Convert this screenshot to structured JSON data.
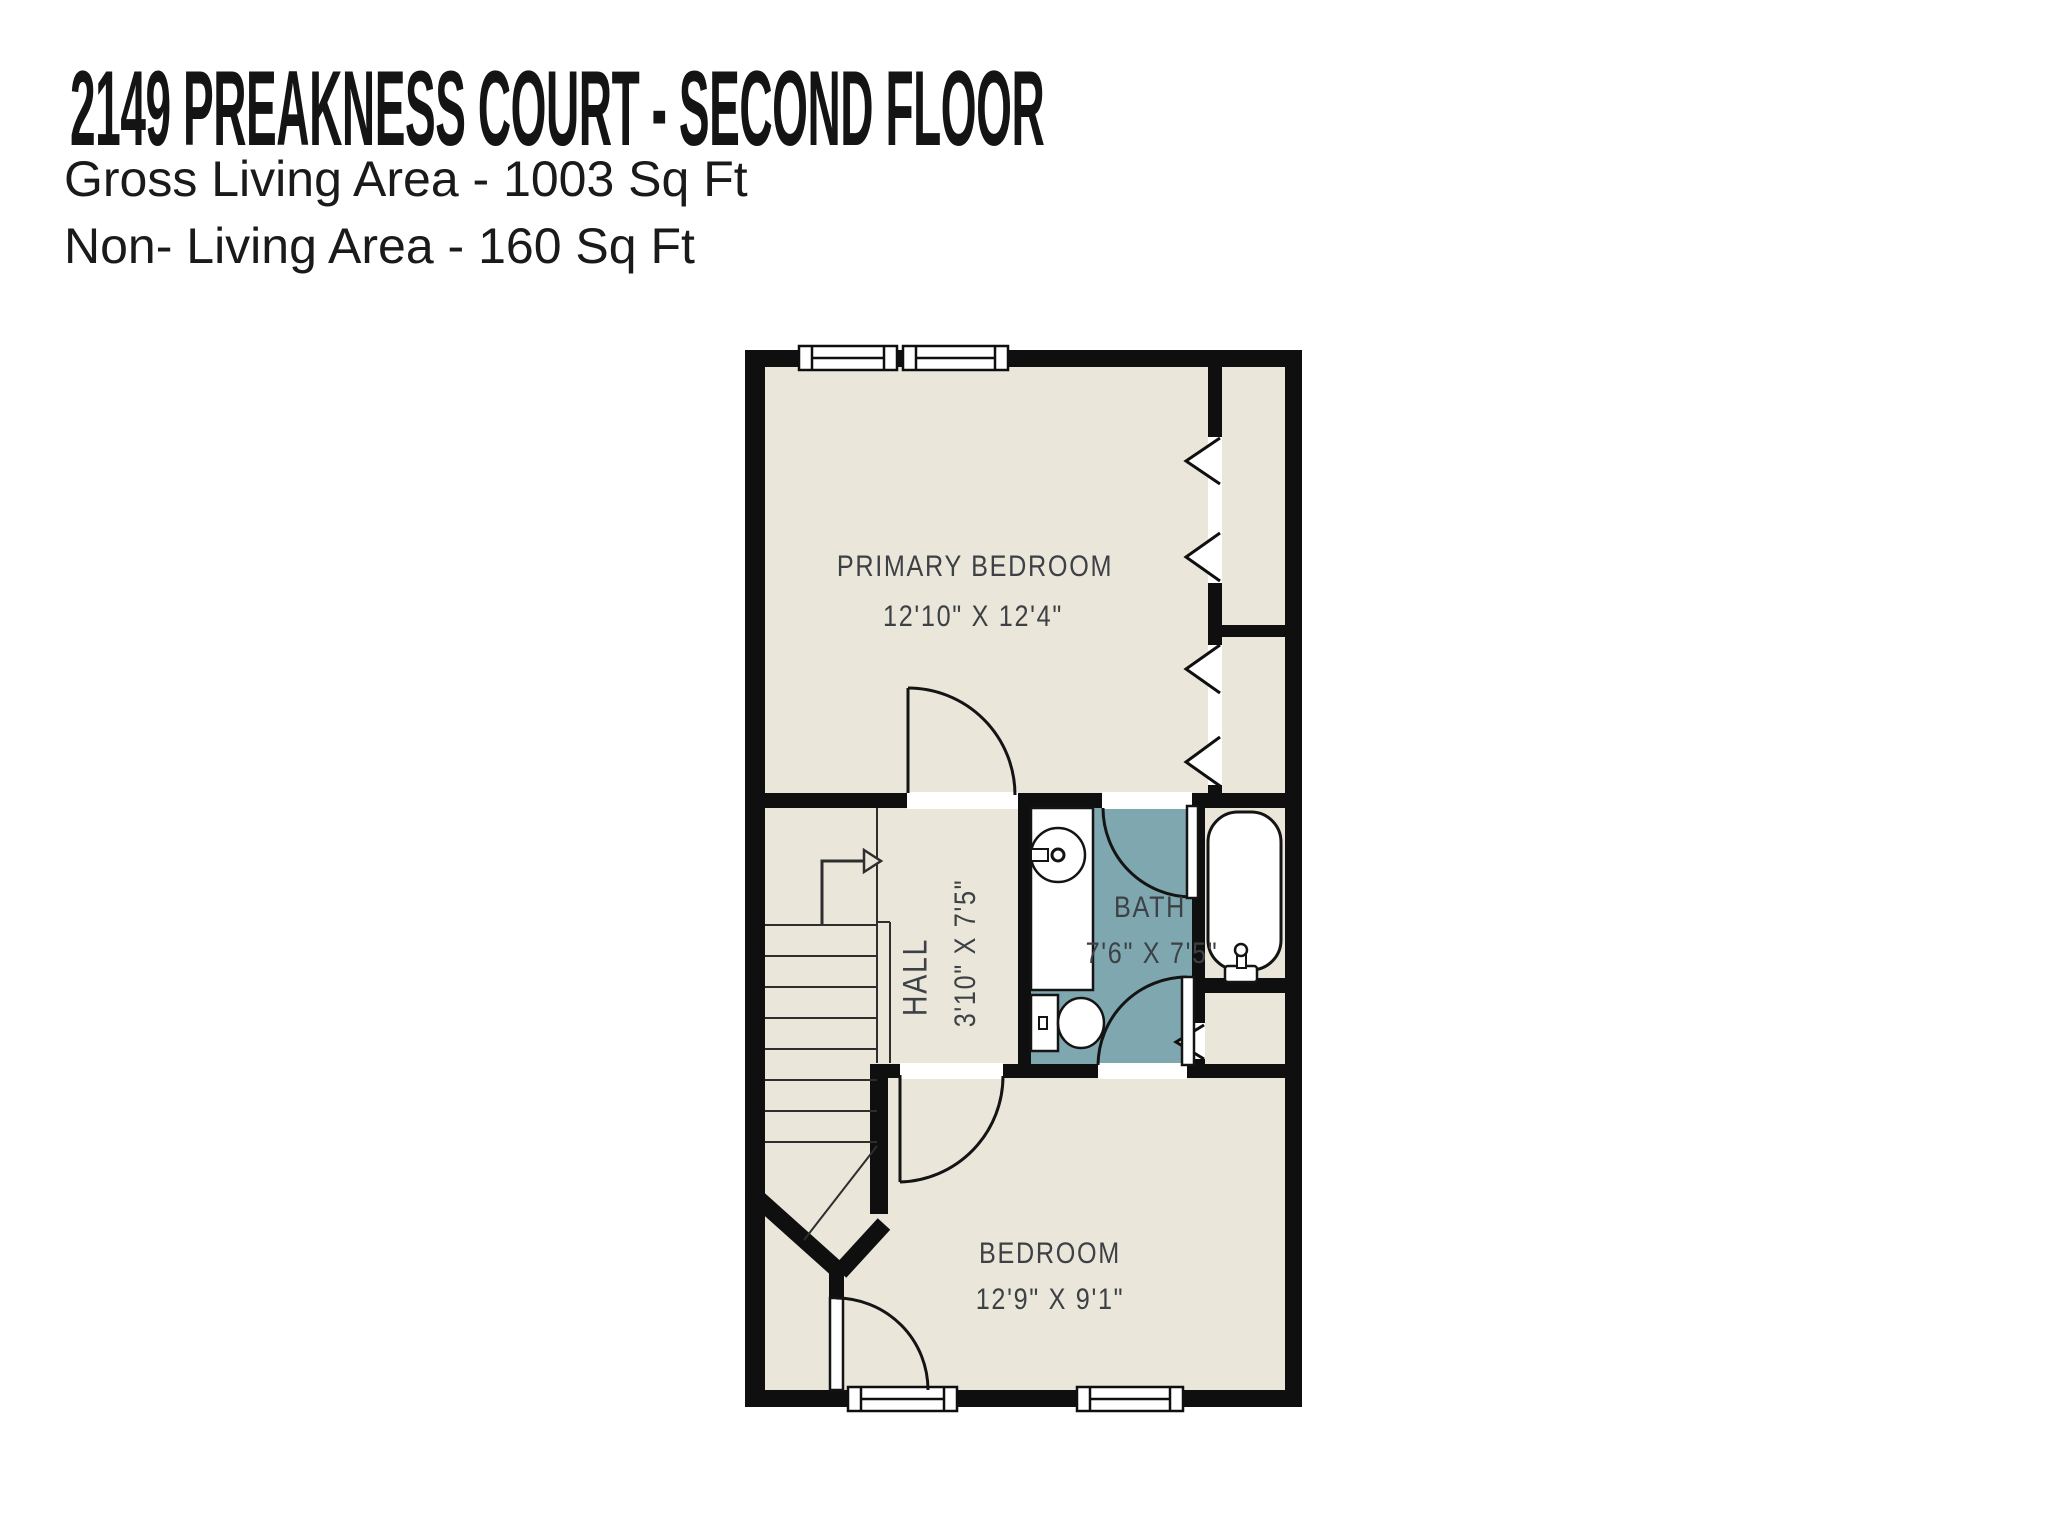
{
  "header": {
    "title": "2149 PREAKNESS COURT - SECOND FLOOR",
    "gross_living_area": "Gross Living Area - 1003 Sq Ft",
    "non_living_area": "Non- Living Area - 160 Sq Ft"
  },
  "floorplan": {
    "rooms": [
      {
        "name": "PRIMARY BEDROOM",
        "dimensions": "12'10\" X 12'4\""
      },
      {
        "name": "HALL",
        "dimensions": "3'10\" X 7'5\""
      },
      {
        "name": "BATH",
        "dimensions": "7'6\" X 7'5\""
      },
      {
        "name": "BEDROOM",
        "dimensions": "12'9\" X 9'1\""
      }
    ],
    "counts": {
      "windows": 4,
      "closets": 3,
      "swing_doors": 5,
      "bifold_doors": 3
    },
    "fixtures": [
      "staircase-up-arrow",
      "sink",
      "toilet",
      "bathtub"
    ],
    "colors": {
      "walls": "#0f0f0f",
      "floor": "#eae6da",
      "bath_floor": "#7ea7af",
      "background": "#ffffff",
      "label_text": "#3d4145"
    }
  }
}
